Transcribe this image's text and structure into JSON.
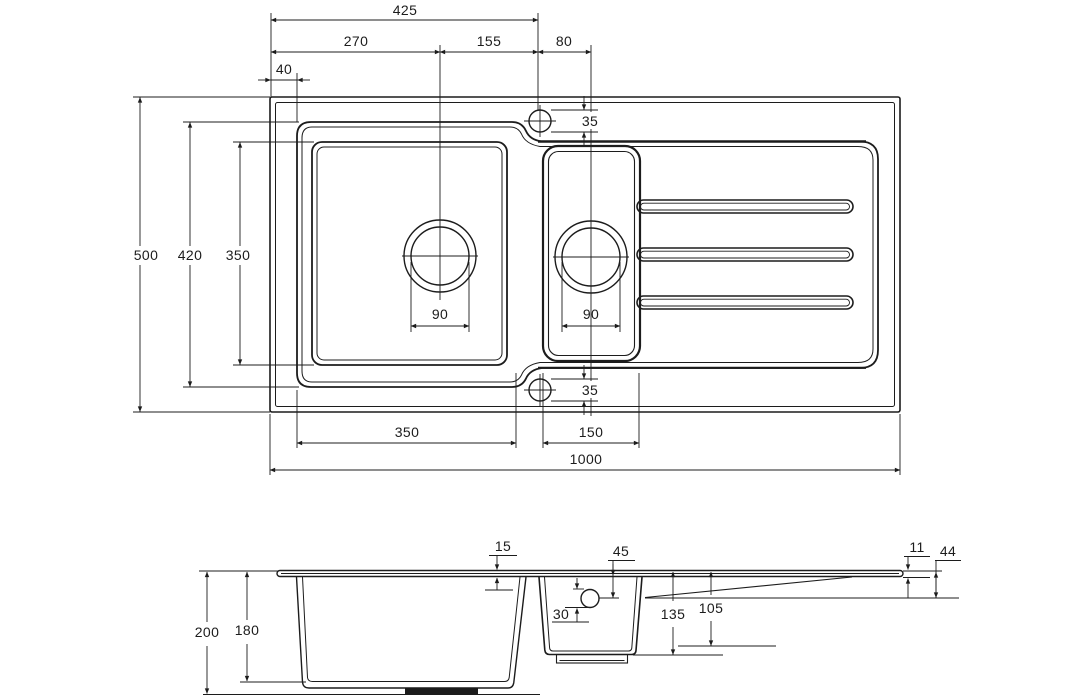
{
  "plan": {
    "dim_top_tap_from_left": "425",
    "dim_left_to_main_drain": "270",
    "dim_main_drain_to_tap": "155",
    "dim_tap_to_half_drain": "80",
    "dim_edge_to_bowl": "40",
    "dim_tap_hole_top": "35",
    "dim_overall_width": "500",
    "dim_bowl_recess_length": "420",
    "dim_main_bowl_inner": "350",
    "dim_main_waste": "90",
    "dim_half_waste": "90",
    "dim_main_bowl_width": "350",
    "dim_half_bowl_width": "150",
    "dim_overall_length": "1000",
    "dim_tap_hole_bottom": "35"
  },
  "section": {
    "dim_overall_depth": "200",
    "dim_main_bowl_depth": "180",
    "dim_rim_height": "15",
    "dim_overflow_from_top": "45",
    "dim_overflow_dia": "30",
    "dim_half_bowl_depth": "135",
    "dim_half_bowl_outer_depth": "105",
    "dim_edge_thickness": "11",
    "dim_drainer_drop": "44"
  }
}
